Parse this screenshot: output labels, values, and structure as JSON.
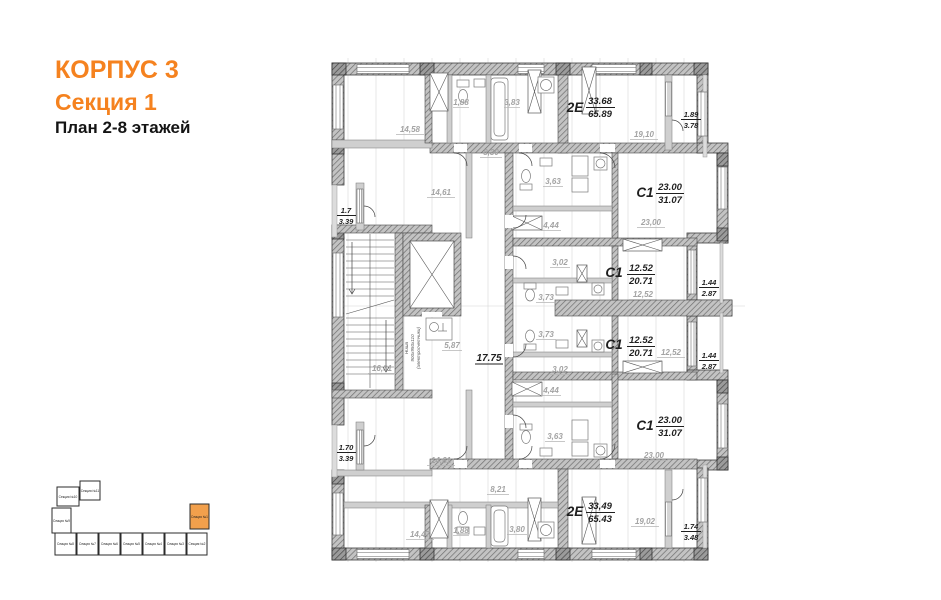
{
  "header": {
    "building": "КОРПУС 3",
    "section": "Секция 1",
    "plan": "План 2-8 этажей"
  },
  "colors": {
    "accent": "#f5821f",
    "keyplan_highlight": "#f2a04c",
    "gray_label": "#a3a3a3",
    "dark_label": "#1f1f1f"
  },
  "apartments": {
    "e2_top": {
      "type": "2Е",
      "living": "33.68",
      "total": "65.89"
    },
    "c1_top": {
      "type": "С1",
      "living": "23.00",
      "total": "31.07"
    },
    "c1_mid_top": {
      "type": "С1",
      "living": "12.52",
      "total": "20.71"
    },
    "c1_mid_bot": {
      "type": "С1",
      "living": "12.52",
      "total": "20.71"
    },
    "c1_bottom": {
      "type": "С1",
      "living": "23.00",
      "total": "31.07"
    },
    "e2_bottom": {
      "type": "2Е",
      "living": "33,49",
      "total": "65.43"
    }
  },
  "areas": {
    "top_left_room": "14,58",
    "top_wc": "1,88",
    "top_bath": "3,83",
    "top_right_room": "19,10",
    "top_hall": "8,30",
    "left_room_upper": "14,61",
    "c1_top_kitchen": "3,63",
    "c1_top_hall": "4,44",
    "c1_top_room": "23,00",
    "mid_hall_upper": "3,02",
    "mid_bath_upper": "3,73",
    "mid_room_upper": "12,52",
    "mid_bath_lower": "3,73",
    "mid_room_lower": "12,52",
    "mid_hall_lower": "3,02",
    "c1_bottom_hall": "4,44",
    "stair_hall": "16,31",
    "lift_lobby": "5,87",
    "corridor": "17.75",
    "c1_bottom_kitchen": "3,63",
    "c1_bottom_room": "23,00",
    "left_room_lower": "14,61",
    "bottom_hall": "8,21",
    "bottom_right_room": "19,02",
    "bottom_left_room": "14,47",
    "bottom_wc": "1,88",
    "bottom_bath": "3,80"
  },
  "balconies": {
    "top_right": {
      "living": "1.89",
      "total": "3.78"
    },
    "left_upper": {
      "living": "1.7",
      "total": "3.39"
    },
    "right_mid_upper": {
      "living": "1.44",
      "total": "2.87"
    },
    "right_mid_lower": {
      "living": "1.44",
      "total": "2.87"
    },
    "left_lower": {
      "living": "1.70",
      "total": "3.39"
    },
    "bottom_right": {
      "living": "1.74",
      "total": "3.48"
    }
  },
  "niche": {
    "line1": "Ниша",
    "line2": "900х950х110",
    "line3": "(электросчетчики)"
  },
  "keyplan": {
    "sections": [
      "Секция №10",
      "Секция №11",
      "Секция №9",
      "Секция №8",
      "Секция №7",
      "Секция №6",
      "Секция №5",
      "Секция №4",
      "Секция №3",
      "Секция №2"
    ],
    "highlighted": "Секция №1"
  }
}
